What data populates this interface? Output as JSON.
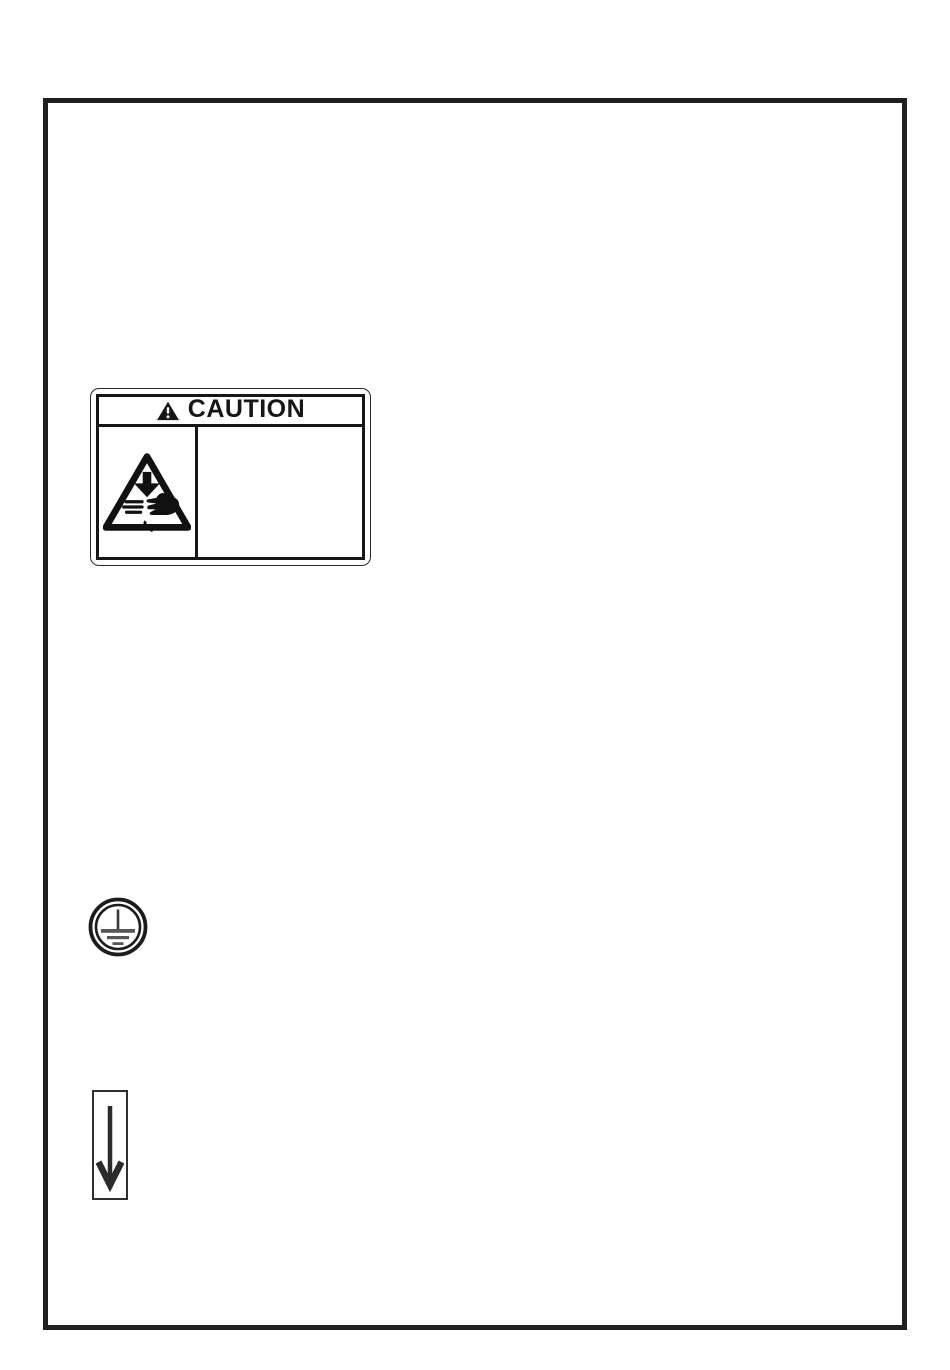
{
  "document": {
    "kind": "instruction-manual-page",
    "caution_label": {
      "title": "CAUTION",
      "header_icon": "warning-triangle-exclamation",
      "pictogram": "hand-injury-hazard",
      "body_text": ""
    },
    "symbols": [
      {
        "name": "protective-earth-ground",
        "description": "double circle with earth/ground bars"
      },
      {
        "name": "down-arrow-in-box",
        "description": "thick downward arrow inside tall rectangle"
      }
    ],
    "colors": {
      "ink": "#231f20",
      "earth_bar_gray": "#565656",
      "paper": "#ffffff"
    }
  }
}
